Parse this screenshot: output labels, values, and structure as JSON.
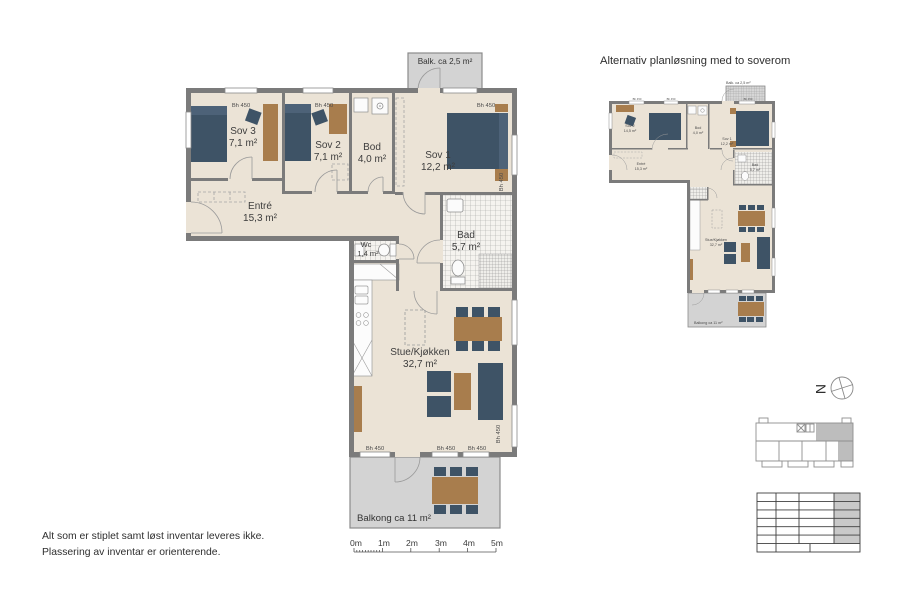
{
  "document": {
    "type": "apartment floor plan sheet",
    "language": "Norwegian"
  },
  "main_plan": {
    "balk_label": "Balk. ca 2,5 m²",
    "balkong_label": "Balkong ca 11 m²",
    "window_height_label": "Bh 450",
    "rooms": {
      "sov3": {
        "name": "Sov 3",
        "area": "7,1 m²"
      },
      "sov2": {
        "name": "Sov 2",
        "area": "7,1 m²"
      },
      "bod": {
        "name": "Bod",
        "area": "4,0 m²"
      },
      "sov1": {
        "name": "Sov 1",
        "area": "12,2 m²"
      },
      "entre": {
        "name": "Entré",
        "area": "15,3 m²"
      },
      "wc": {
        "name": "Wc",
        "area": "1,4 m²"
      },
      "bad": {
        "name": "Bad",
        "area": "5,7 m²"
      },
      "stue": {
        "name": "Stue/Kjøkken",
        "area": "32,7 m²"
      }
    }
  },
  "alt_plan": {
    "title": "Alternativ planløsning med to soverom",
    "balk_label": "Balk. ca 2,5 m²",
    "balkong_label": "Balkong ca 11 m²",
    "window_height_label": "Bh 450",
    "rooms": {
      "sov2": {
        "name": "Sov 2",
        "area": "14,5 m²"
      },
      "bod": {
        "name": "Bod",
        "area": "4,0 m²"
      },
      "sov1": {
        "name": "Sov 1",
        "area": "12,2 m²"
      },
      "entre": {
        "name": "Entré",
        "area": "15,3 m²"
      },
      "bad": {
        "name": "Bad",
        "area": "5,7 m²"
      },
      "stue": {
        "name": "Stue/Kjøkken",
        "area": "32,7 m²"
      }
    }
  },
  "north_indicator": {
    "label": "N"
  },
  "scale_bar": {
    "labels": [
      "0m",
      "1m",
      "2m",
      "3m",
      "4m",
      "5m"
    ]
  },
  "disclaimer": {
    "line1": "Alt som er stiplet samt løst inventar leveres ikke.",
    "line2": "Plassering av inventar er orienterende."
  },
  "colors": {
    "floor": "#ebe3d6",
    "wall": "#7b7b7b",
    "furniture_dark_blue": "#3e5366",
    "furniture_wood": "#a87d4d",
    "balcony_gray": "#d3d3d3",
    "keyplan_highlight": "#bdbdbd"
  }
}
